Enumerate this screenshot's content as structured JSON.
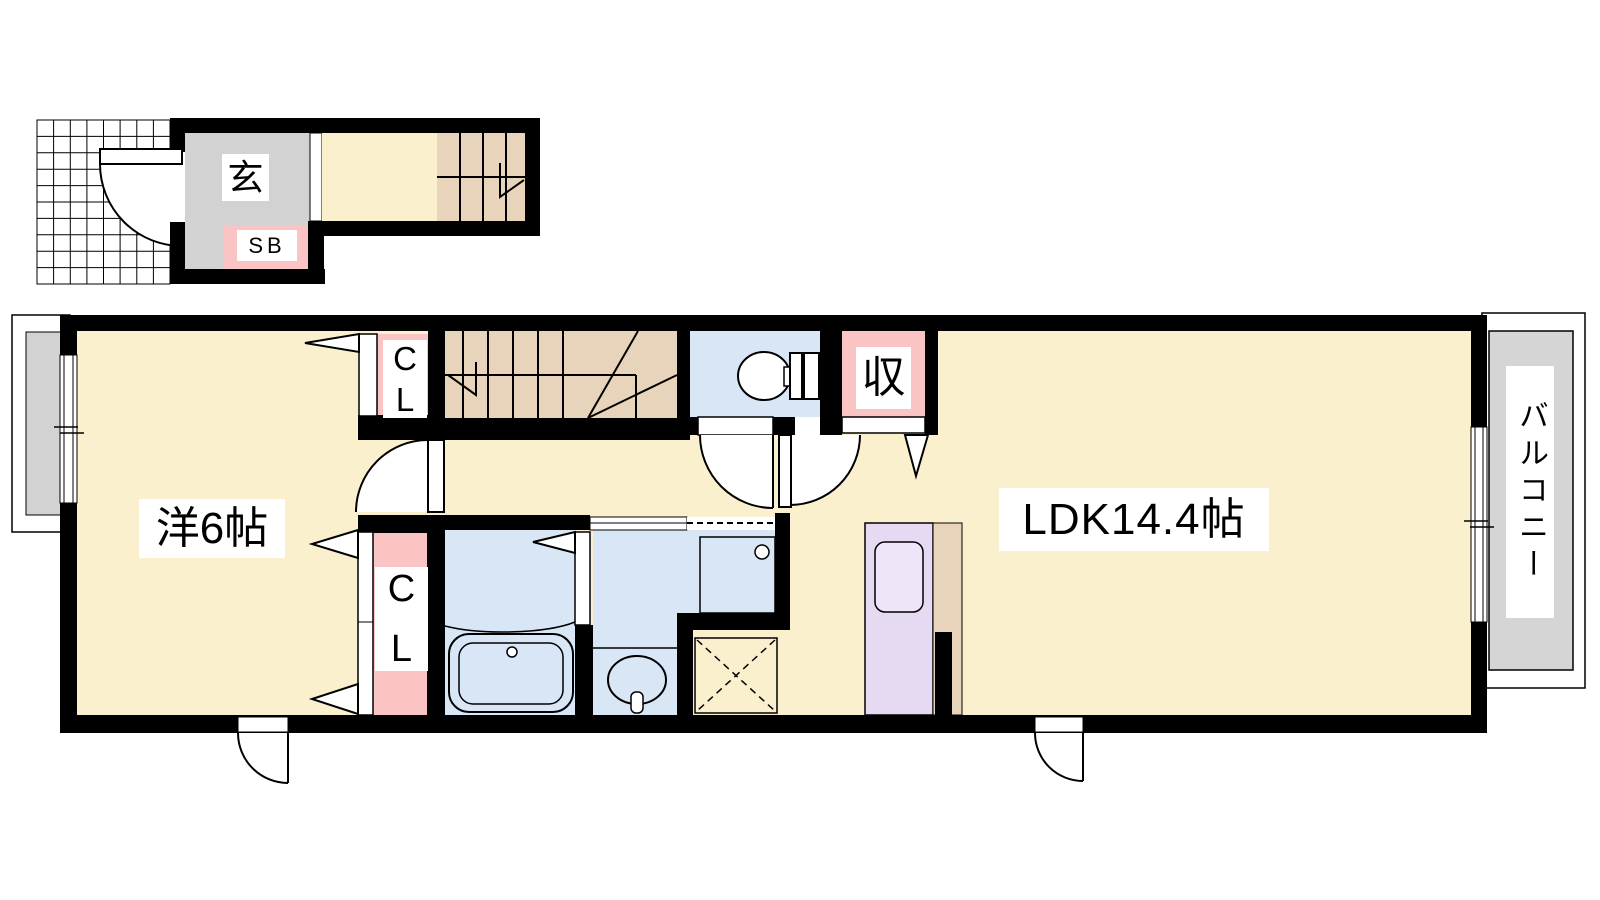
{
  "colors": {
    "wall": "#000000",
    "floor": "#FBF0CE",
    "stairs": "#E7D4BA",
    "water": "#D8E6F6",
    "closet": "#FAC4C4",
    "kitchen": "#E5DAF2",
    "kitchen_sink": "#EEE6F8",
    "entrance_gray": "#D2D2D2",
    "balcony_gray": "#D5D5D5"
  },
  "first_floor": {
    "entrance_label": "玄",
    "shoe_box_label": "SB"
  },
  "second_floor": {
    "western_room_label": "洋6帖",
    "ldk_label": "LDK14.4帖",
    "storage_label": "収",
    "balcony_label": "バルコニー",
    "closet_upper": {
      "line1": "C",
      "line2": "L"
    },
    "closet_lower": {
      "line1": "C",
      "line2": "L"
    }
  }
}
